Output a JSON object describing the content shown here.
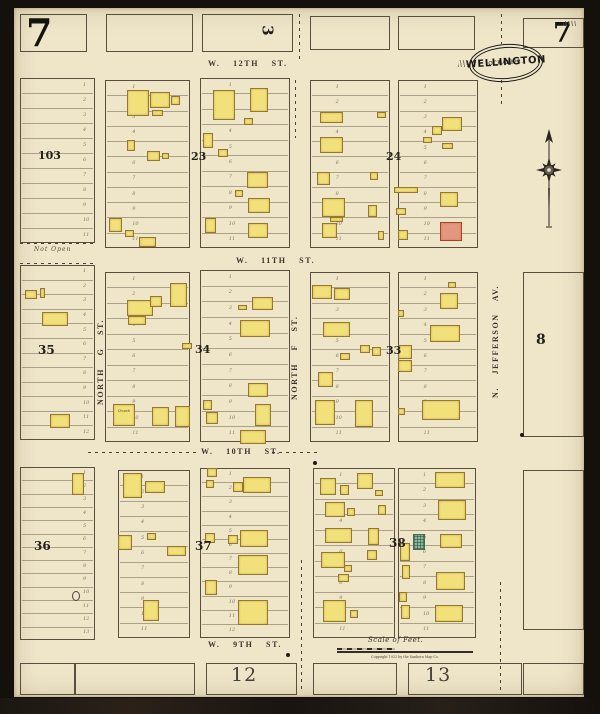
{
  "sheet": {
    "number_top_left": "7",
    "number_top_right": "7"
  },
  "stamp": {
    "date": "OCT. 1922.",
    "city": "WELLINGTON",
    "state": "KAS."
  },
  "streets": {
    "w12th": "W. 12TH ST.",
    "w11th": "W. 11TH ST.",
    "w10th": "W. 10TH ST.",
    "w9th": "W. 9TH ST.",
    "north_g": "NORTH G ST.",
    "north_f": "NORTH F ST.",
    "jefferson": "N. JEFFERSON AV."
  },
  "annotations": {
    "not_open": "Not Open",
    "church": "Church",
    "scale_label": "Scale of Feet.",
    "copyright": "Copyright 1922 by the Sanborn Map Co."
  },
  "legend_colors": {
    "frame_building": "#f2e17a",
    "brick_building": "#e5967e",
    "special_building": "#8fb8a4",
    "paper": "#efe6ca"
  },
  "map": {
    "block_numbers": [
      {
        "label": "103",
        "x": 38,
        "y": 150,
        "size": 11
      },
      {
        "label": "23",
        "x": 191,
        "y": 151,
        "size": 11
      },
      {
        "label": "24",
        "x": 386,
        "y": 151,
        "size": 11
      },
      {
        "label": "35",
        "x": 38,
        "y": 344,
        "size": 12
      },
      {
        "label": "34",
        "x": 195,
        "y": 344,
        "size": 11
      },
      {
        "label": "33",
        "x": 386,
        "y": 345,
        "size": 11
      },
      {
        "label": "36",
        "x": 34,
        "y": 540,
        "size": 12
      },
      {
        "label": "37",
        "x": 195,
        "y": 540,
        "size": 12
      },
      {
        "label": "38",
        "x": 389,
        "y": 537,
        "size": 12
      },
      {
        "label": "8",
        "x": 536,
        "y": 333,
        "size": 14
      },
      {
        "label": "3",
        "x": 262,
        "y": 23,
        "size": 15,
        "rot": 90
      },
      {
        "label": "12",
        "x": 231,
        "y": 666,
        "size": 19,
        "light": true
      },
      {
        "label": "13",
        "x": 425,
        "y": 666,
        "size": 19,
        "light": true
      }
    ],
    "lot_blocks": [
      [
        20,
        14,
        67,
        38,
        0,
        0
      ],
      [
        106,
        14,
        87,
        38,
        0,
        0
      ],
      [
        202,
        14,
        91,
        38,
        0,
        0
      ],
      [
        310,
        16,
        80,
        34,
        0,
        0
      ],
      [
        398,
        16,
        77,
        34,
        0,
        0
      ],
      [
        523,
        18,
        61,
        30,
        0,
        0
      ],
      [
        20,
        78,
        75,
        165,
        11,
        "r"
      ],
      [
        105,
        80,
        85,
        168,
        11,
        "c"
      ],
      [
        200,
        78,
        90,
        170,
        11,
        "c"
      ],
      [
        310,
        80,
        80,
        168,
        11,
        "c"
      ],
      [
        398,
        80,
        80,
        168,
        11,
        "c"
      ],
      [
        20,
        265,
        75,
        175,
        12,
        "r"
      ],
      [
        105,
        272,
        85,
        170,
        11,
        "c"
      ],
      [
        200,
        270,
        90,
        172,
        11,
        "c"
      ],
      [
        310,
        272,
        80,
        170,
        11,
        "c"
      ],
      [
        398,
        272,
        80,
        170,
        11,
        "c"
      ],
      [
        523,
        272,
        61,
        165,
        0,
        0
      ],
      [
        20,
        467,
        75,
        173,
        13,
        "r"
      ],
      [
        118,
        470,
        72,
        168,
        11,
        "c"
      ],
      [
        200,
        468,
        90,
        170,
        12,
        "c"
      ],
      [
        313,
        468,
        82,
        170,
        11,
        "c"
      ],
      [
        398,
        468,
        78,
        170,
        11,
        "c"
      ],
      [
        523,
        470,
        61,
        160,
        0,
        0
      ],
      [
        20,
        663,
        55,
        32,
        0,
        0
      ],
      [
        75,
        663,
        120,
        32,
        0,
        0
      ],
      [
        206,
        663,
        91,
        32,
        0,
        0
      ],
      [
        313,
        663,
        84,
        32,
        0,
        0
      ],
      [
        408,
        663,
        114,
        32,
        0,
        0
      ],
      [
        523,
        663,
        61,
        32,
        0,
        0
      ]
    ],
    "buildings": [
      [
        127,
        90,
        22,
        26
      ],
      [
        150,
        92,
        20,
        16
      ],
      [
        171,
        96,
        9,
        9
      ],
      [
        152,
        110,
        11,
        6
      ],
      [
        127,
        140,
        8,
        11
      ],
      [
        147,
        151,
        13,
        10
      ],
      [
        162,
        153,
        7,
        6
      ],
      [
        109,
        218,
        13,
        14
      ],
      [
        125,
        230,
        9,
        7
      ],
      [
        139,
        237,
        17,
        10
      ],
      [
        213,
        90,
        22,
        30
      ],
      [
        250,
        88,
        18,
        24
      ],
      [
        244,
        118,
        9,
        7
      ],
      [
        203,
        133,
        10,
        15
      ],
      [
        218,
        149,
        10,
        8
      ],
      [
        247,
        172,
        21,
        16
      ],
      [
        235,
        190,
        8,
        7
      ],
      [
        248,
        198,
        22,
        15
      ],
      [
        205,
        218,
        11,
        15
      ],
      [
        248,
        223,
        20,
        15
      ],
      [
        320,
        112,
        23,
        11
      ],
      [
        377,
        112,
        9,
        6
      ],
      [
        320,
        137,
        23,
        16
      ],
      [
        317,
        172,
        13,
        13
      ],
      [
        370,
        172,
        8,
        8
      ],
      [
        322,
        198,
        23,
        19
      ],
      [
        330,
        217,
        13,
        5
      ],
      [
        322,
        223,
        15,
        15
      ],
      [
        368,
        205,
        9,
        12
      ],
      [
        378,
        231,
        6,
        9
      ],
      [
        394,
        187,
        24,
        6
      ],
      [
        442,
        117,
        20,
        14
      ],
      [
        432,
        126,
        10,
        9
      ],
      [
        423,
        137,
        9,
        6
      ],
      [
        442,
        143,
        11,
        6
      ],
      [
        440,
        192,
        18,
        15
      ],
      [
        396,
        208,
        10,
        7
      ],
      [
        440,
        222,
        22,
        19,
        "r"
      ],
      [
        398,
        230,
        10,
        10
      ],
      [
        25,
        290,
        12,
        9
      ],
      [
        40,
        288,
        5,
        10
      ],
      [
        42,
        312,
        26,
        14
      ],
      [
        50,
        414,
        20,
        14
      ],
      [
        127,
        300,
        26,
        16
      ],
      [
        150,
        296,
        12,
        11
      ],
      [
        128,
        316,
        18,
        9
      ],
      [
        170,
        283,
        17,
        24
      ],
      [
        182,
        343,
        10,
        6
      ],
      [
        113,
        404,
        22,
        22
      ],
      [
        152,
        407,
        17,
        19
      ],
      [
        175,
        406,
        15,
        21
      ],
      [
        252,
        297,
        21,
        13
      ],
      [
        238,
        305,
        9,
        5
      ],
      [
        240,
        320,
        30,
        17
      ],
      [
        248,
        383,
        20,
        14
      ],
      [
        255,
        404,
        16,
        22
      ],
      [
        203,
        400,
        9,
        10
      ],
      [
        206,
        412,
        12,
        12
      ],
      [
        240,
        430,
        26,
        14
      ],
      [
        312,
        285,
        20,
        14
      ],
      [
        334,
        288,
        16,
        12
      ],
      [
        323,
        322,
        27,
        15
      ],
      [
        360,
        345,
        10,
        8
      ],
      [
        372,
        347,
        9,
        9
      ],
      [
        340,
        353,
        10,
        7
      ],
      [
        318,
        372,
        15,
        15
      ],
      [
        315,
        400,
        20,
        25
      ],
      [
        355,
        400,
        18,
        27
      ],
      [
        448,
        282,
        8,
        6
      ],
      [
        440,
        293,
        18,
        16
      ],
      [
        398,
        310,
        6,
        7
      ],
      [
        430,
        325,
        30,
        17
      ],
      [
        398,
        345,
        14,
        14
      ],
      [
        398,
        360,
        14,
        12
      ],
      [
        422,
        400,
        38,
        20
      ],
      [
        398,
        408,
        7,
        7
      ],
      [
        72,
        473,
        12,
        22
      ],
      [
        123,
        473,
        19,
        25
      ],
      [
        145,
        481,
        20,
        12
      ],
      [
        118,
        535,
        14,
        15
      ],
      [
        147,
        533,
        9,
        7
      ],
      [
        167,
        546,
        19,
        10
      ],
      [
        143,
        600,
        16,
        21
      ],
      [
        207,
        468,
        10,
        9
      ],
      [
        206,
        480,
        8,
        8
      ],
      [
        233,
        482,
        10,
        10
      ],
      [
        243,
        477,
        28,
        16
      ],
      [
        240,
        530,
        28,
        17
      ],
      [
        228,
        535,
        10,
        9
      ],
      [
        205,
        533,
        10,
        10
      ],
      [
        238,
        555,
        30,
        20
      ],
      [
        205,
        580,
        12,
        15
      ],
      [
        238,
        600,
        30,
        25
      ],
      [
        320,
        478,
        16,
        17
      ],
      [
        340,
        485,
        9,
        10
      ],
      [
        357,
        473,
        16,
        16
      ],
      [
        375,
        490,
        8,
        6
      ],
      [
        325,
        502,
        20,
        15
      ],
      [
        347,
        508,
        8,
        8
      ],
      [
        378,
        505,
        8,
        10
      ],
      [
        325,
        528,
        27,
        15
      ],
      [
        368,
        528,
        11,
        17
      ],
      [
        321,
        552,
        24,
        16
      ],
      [
        367,
        550,
        10,
        10
      ],
      [
        344,
        565,
        8,
        7
      ],
      [
        338,
        574,
        11,
        8
      ],
      [
        323,
        600,
        23,
        22
      ],
      [
        350,
        610,
        8,
        8
      ],
      [
        435,
        472,
        30,
        16
      ],
      [
        438,
        500,
        28,
        20
      ],
      [
        413,
        534,
        12,
        16,
        "g"
      ],
      [
        440,
        534,
        22,
        14
      ],
      [
        400,
        543,
        10,
        18
      ],
      [
        402,
        565,
        8,
        14
      ],
      [
        436,
        572,
        29,
        18
      ],
      [
        399,
        592,
        8,
        10
      ],
      [
        401,
        605,
        9,
        14
      ],
      [
        435,
        605,
        28,
        17
      ]
    ],
    "dashes_v": [
      [
        299,
        14,
        48
      ],
      [
        295,
        80,
        58
      ],
      [
        301,
        560,
        133
      ],
      [
        501,
        14,
        30
      ],
      [
        501,
        80,
        26
      ],
      [
        500,
        582,
        112
      ]
    ],
    "dashes_h": [
      [
        20,
        243,
        75
      ],
      [
        20,
        263,
        75
      ],
      [
        88,
        452,
        110
      ],
      [
        272,
        452,
        48
      ]
    ],
    "dots": [
      [
        288,
        655
      ],
      [
        315,
        463
      ],
      [
        522,
        435
      ]
    ],
    "circles": [
      [
        72,
        591,
        8,
        10
      ]
    ]
  }
}
